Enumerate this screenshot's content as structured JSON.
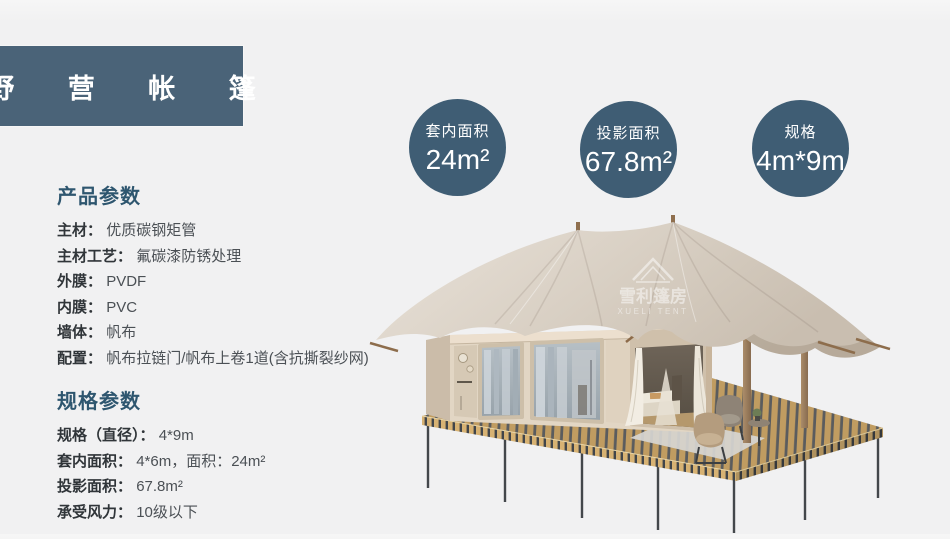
{
  "page": {
    "title": "野 营 帐 篷"
  },
  "stats": [
    {
      "label": "套内面积",
      "value": "24m²"
    },
    {
      "label": "投影面积",
      "value": "67.8m²"
    },
    {
      "label": "规格",
      "value": "4m*9m"
    }
  ],
  "product_params": {
    "heading": "产品参数",
    "rows": [
      {
        "label": "主材：",
        "value": "优质碳钢矩管"
      },
      {
        "label": "主材工艺：",
        "value": "氟碳漆防锈处理"
      },
      {
        "label": "外膜：",
        "value": "PVDF"
      },
      {
        "label": "内膜：",
        "value": "PVC"
      },
      {
        "label": "墙体：",
        "value": "帆布"
      },
      {
        "label": "配置：",
        "value": "帆布拉链门/帆布上卷1道(含抗撕裂纱网)"
      }
    ]
  },
  "spec_params": {
    "heading": "规格参数",
    "rows": [
      {
        "label": "规格（直径）：",
        "value": "4*9m"
      },
      {
        "label": "套内面积：",
        "value": "4*6m，面积：24m²"
      },
      {
        "label": "投影面积：",
        "value": "67.8m²"
      },
      {
        "label": "承受风力：",
        "value": "10级以下"
      }
    ]
  },
  "watermark": {
    "cn": "雪利篷房",
    "en": "XUELI TENT"
  },
  "colors": {
    "background": "#f1f1f2",
    "banner": "#4a6378",
    "circle": "#3f5d74",
    "heading": "#2e566f",
    "canvas": "#d8cfc3",
    "wood_deck": "#c9a466"
  }
}
